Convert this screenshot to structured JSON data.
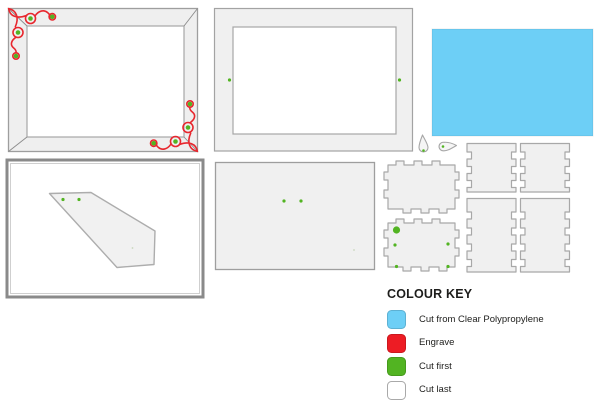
{
  "legend": {
    "title": "COLOUR KEY",
    "items": [
      {
        "label": "Cut from Clear Polypropylene",
        "color": "#6DCFF6"
      },
      {
        "label": "Engrave",
        "color": "#ED1C24"
      },
      {
        "label": "Cut first",
        "color": "#52B422"
      },
      {
        "label": "Cut last",
        "color": "#FFFFFF"
      }
    ]
  },
  "palette": {
    "cut_polypropylene": "#6DCFF6",
    "engrave": "#E8272E",
    "cut_first": "#52B422",
    "cut_last": "#FFFFFF",
    "part_fill": "#F0F0F0",
    "part_outline": "#A3A3A3",
    "board_border": "#8A8A8A"
  }
}
